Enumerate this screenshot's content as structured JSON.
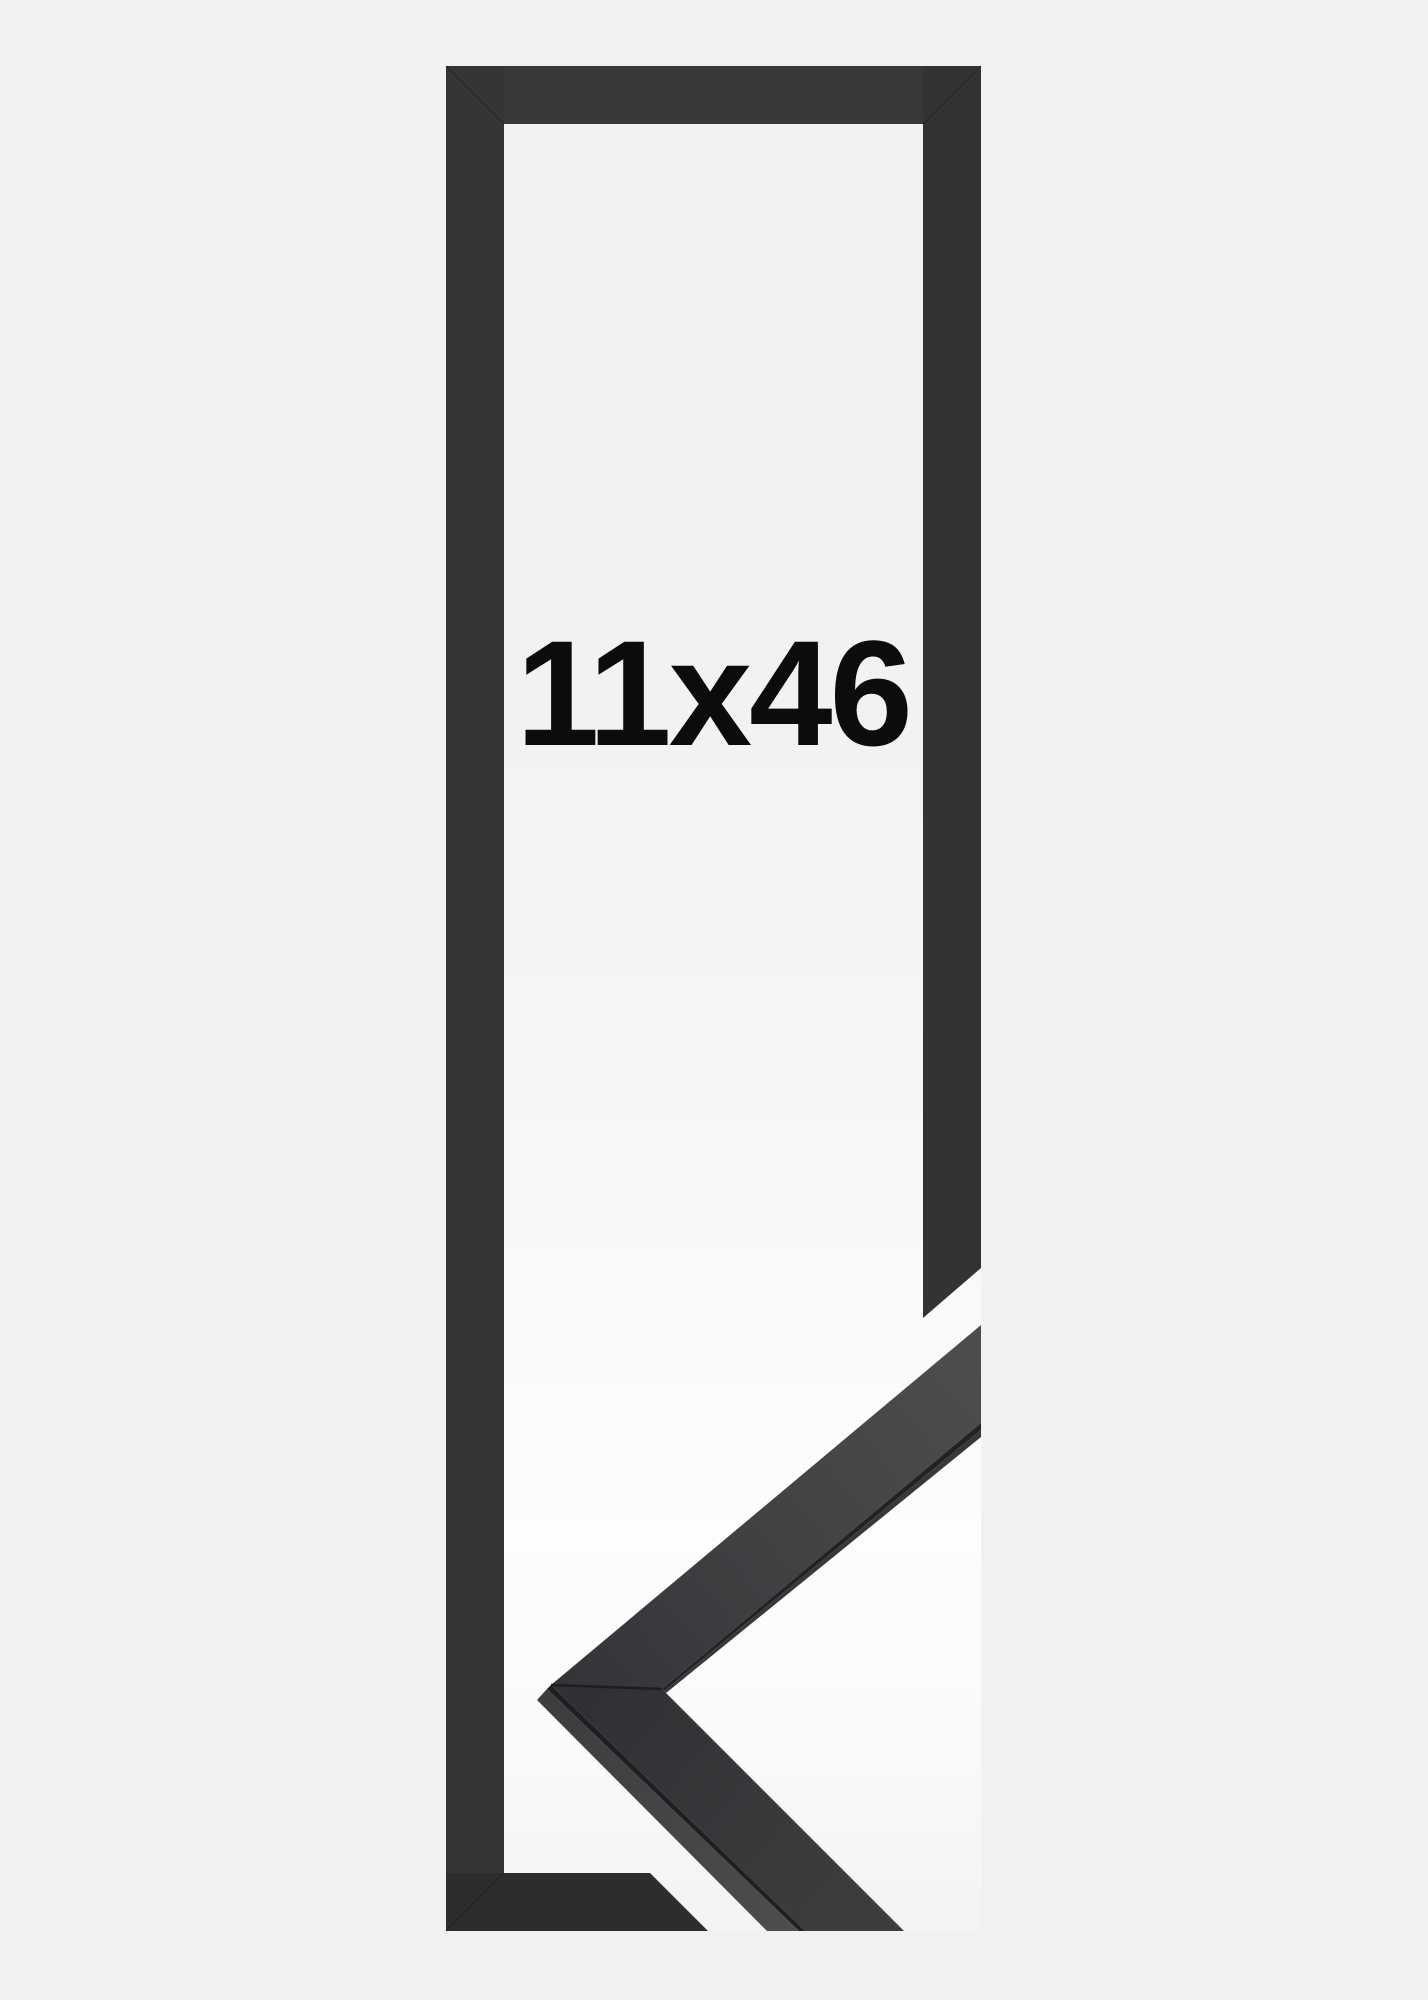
{
  "page": {
    "background_color": "#f1f1f1"
  },
  "product_image": {
    "size_label": "11x46",
    "label_color": "#0c0c0d",
    "frame": {
      "top_bar_color": "#37383a",
      "left_bar_color": "#343537",
      "right_bar_color": "#323335",
      "bottom_bar_color": "#2c2d2f",
      "miter_seam_color": "rgba(0,0,0,0.22)"
    },
    "moulding_sample": {
      "upper_edge_color": "#212224",
      "upper_inner_strip_color": "#37383a",
      "lower_edge_color": "#1e1f21",
      "corner_seam_color": "#1d1e20"
    }
  }
}
